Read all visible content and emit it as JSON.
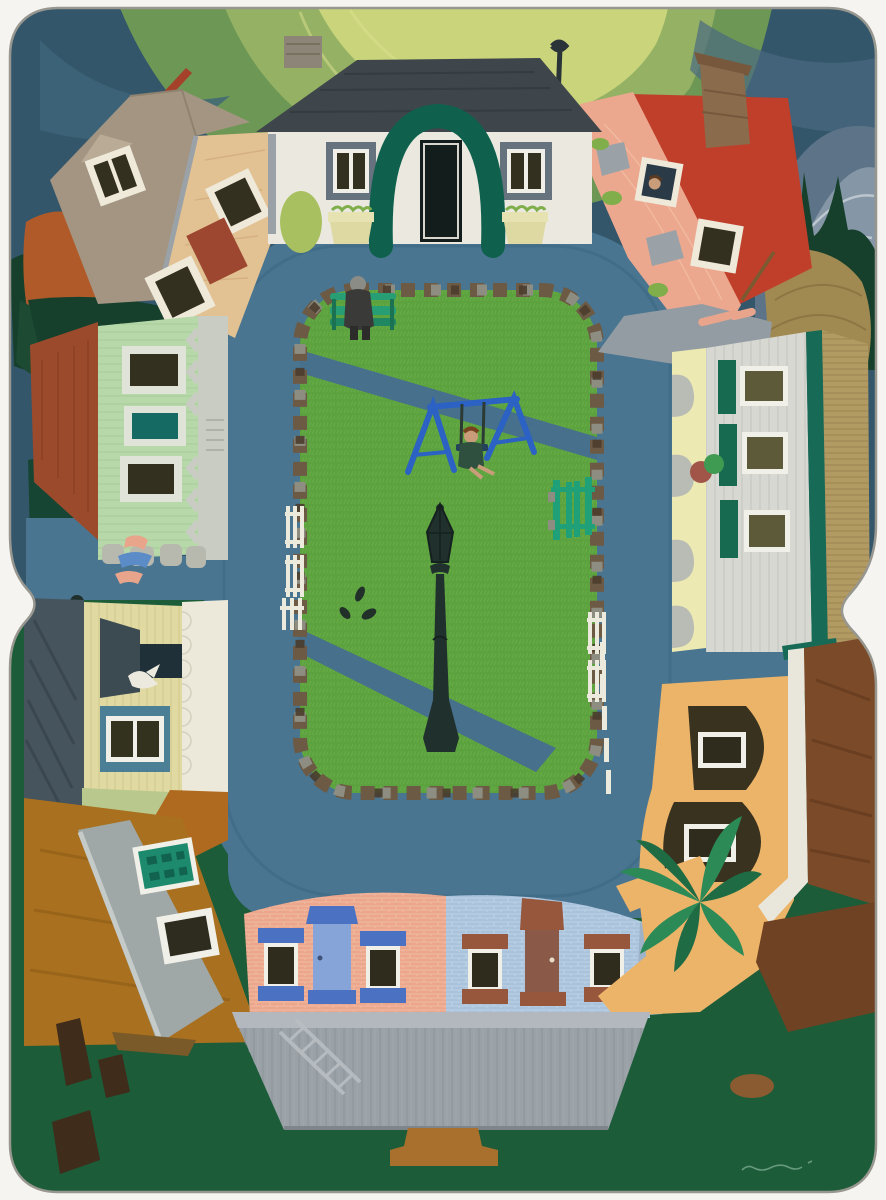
{
  "artwork": {
    "type": "shaped-canvas naive folk-art painting, photographed on white background",
    "subject": "curved aerial (fisheye) view of a village square: houses ring a slate-blue road around a central green park with a bench, blue swing set, black lamp post, picket fences and stone border",
    "canvas_shape": "two vertically stacked rounded-corner panels with a pinched waist at mid-height",
    "signature": "faint illegible artist signature, lower right corner"
  },
  "palette": {
    "mat_white": "#f5f4f1",
    "sky": "#34566b",
    "sky_swirl_deep": "#6d9754",
    "sky_swirl_mid": "#94b164",
    "sky_swirl_light": "#c9d47b",
    "distant_mountains": "#5d7488",
    "distant_mountains_light": "#8596a6",
    "tree_dark_green": "#17402c",
    "tree_orange": "#b05a2a",
    "road": "#497590",
    "park_grass": "#5ca23f",
    "park_path": "#47708c",
    "stone_brown": "#6d5a44",
    "stone_gray": "#8d8d82",
    "bench_green": "#279e74",
    "swing_blue": "#2b62c3",
    "lamp_black": "#20302c",
    "fence_white": "#eceadd",
    "gate_green": "#1fa078",
    "cottage_wall": "#eae8df",
    "cottage_roof": "#3e464c",
    "cottage_arch": "#0f614d",
    "cottage_door": "#131e1c",
    "cottage_trim": "#67727f",
    "planter_yellow": "#ded9a2",
    "tan_house_wall": "#e2c193",
    "tan_house_roof": "#a39582",
    "salmon_house_wall": "#eca88e",
    "salmon_house_roof": "#bf3f2b",
    "chimney_brown": "#8a6b4c",
    "mint_house_wall": "#b7d8a9",
    "mint_house_roof": "#9c4a2c",
    "mint_house_trim": "#c8ccc2",
    "teal_window": "#156a64",
    "white_house_wall": "#d7d8d2",
    "white_house_shutter": "#17694f",
    "white_house_roof": "#b29a63",
    "sidewalk_yellow": "#ece9b2",
    "yellow_house_wall": "#e0d9a2",
    "yellow_house_roof": "#46545e",
    "bay_window_teal": "#4b7f95",
    "gray_house_wall": "#9fa8a7",
    "gray_house_roof": "#a8701f",
    "teal_door": "#1d8a6e",
    "rowhouse_pink": "#eba68c",
    "rowhouse_pink_trim": "#4a71c2",
    "rowhouse_pink_door": "#86a4d8",
    "rowhouse_blue": "#a9c3dd",
    "rowhouse_blue_trim": "#96573d",
    "rowhouse_blue_door": "#8a5947",
    "foreground_roof": "#9aa1a7",
    "ground_green": "#1c5c39",
    "orange_house_wall": "#ecb469",
    "orange_house_roof": "#7b4a28",
    "palm_green": "#2c8a57",
    "window_dark": "#2f2c1d",
    "window_olive": "#5d5a39"
  }
}
